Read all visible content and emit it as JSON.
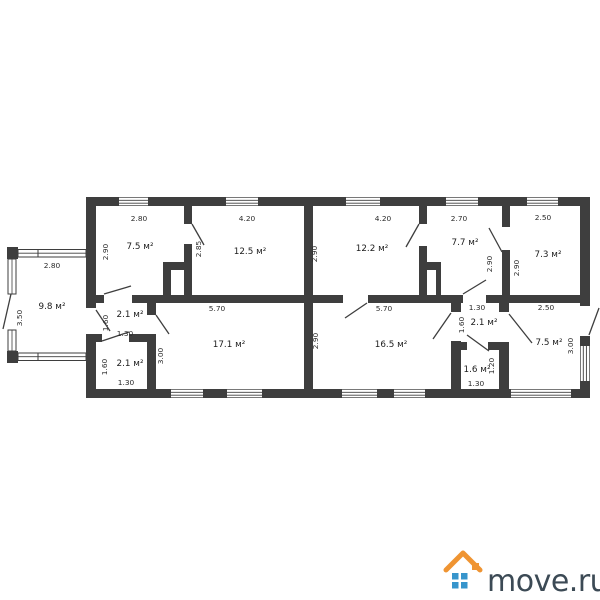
{
  "colors": {
    "wall": "#3e3e3e",
    "logo_roof": "#ef9432",
    "logo_windows": "#3795cc",
    "logo_text": "#3c4a55"
  },
  "logo": {
    "text": "move.ru"
  },
  "rooms": {
    "veranda": {
      "area": "9.8 м²",
      "width": "2.80",
      "height": "3.50"
    },
    "room75_tl": {
      "area": "7.5 м²",
      "width": "2.80",
      "height": "2.90"
    },
    "room125": {
      "area": "12.5 м²",
      "width": "4.20",
      "height": "2.85"
    },
    "room122": {
      "area": "12.2 м²",
      "width": "4.20",
      "height": "2.90"
    },
    "room77": {
      "area": "7.7 м²",
      "width": "2.70",
      "height": "2.90"
    },
    "room73": {
      "area": "7.3 м²",
      "width": "2.50",
      "height": "2.90"
    },
    "hall21": {
      "area": "2.1 м²",
      "width": "1.30",
      "height": "1.60"
    },
    "room21_lower": {
      "area": "2.1 м²",
      "width": "1.30",
      "height": "1.60"
    },
    "room171": {
      "area": "17.1 м²",
      "width": "5.70",
      "height": "3.00"
    },
    "room165": {
      "area": "16.5 м²",
      "width": "5.70",
      "height": "2.90"
    },
    "vest21": {
      "area": "2.1 м²",
      "width": "1.30",
      "height": "1.60"
    },
    "room16": {
      "area": "1.6 м²",
      "width": "1.30",
      "height": "1.20"
    },
    "room75_br": {
      "area": "7.5 м²",
      "width": "2.50",
      "height": "3.00"
    }
  }
}
